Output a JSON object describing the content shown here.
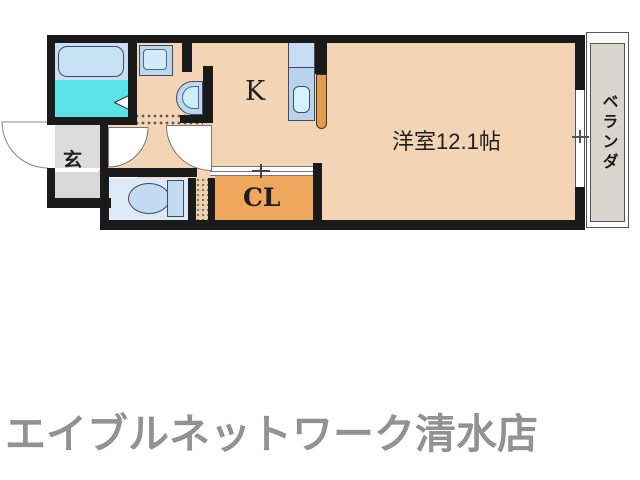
{
  "floor_plan": {
    "rooms": {
      "kitchen": {
        "label": "K"
      },
      "main_room": {
        "label": "洋室12.1帖"
      },
      "closet": {
        "label": "CL"
      },
      "entrance": {
        "label": "玄"
      },
      "veranda": {
        "label": "ベランダ"
      }
    },
    "fixtures": [
      "bathtub-icon",
      "bath-door-triangle-icon",
      "washing-machine-pan-icon",
      "washbasin-icon",
      "toilet-icon",
      "kitchen-sink-counter-icon",
      "entrance-door-arc-icon",
      "interior-door-arc-icon",
      "sliding-window-icon",
      "closet-sliding-door-icon",
      "folding-door-icon",
      "open-door-leaf-icon"
    ],
    "colors": {
      "wall": "#1a1a1a",
      "floor_peach": "#f3d5b5",
      "closet_orange": "#efa75e",
      "door_leaf_orange": "#e29c50",
      "bath_cyan": "#59e3e8",
      "bathtub_band": "#ccdcf2",
      "fixture_blue": "#bdd7f2",
      "toilet_floor_blue": "#dde9f7",
      "entrance_gray": "#dcdcdc",
      "veranda_gray": "#d9d5cd",
      "footer_gray": "#929292"
    }
  },
  "footer": {
    "store_name": "エイブルネットワーク清水店"
  }
}
